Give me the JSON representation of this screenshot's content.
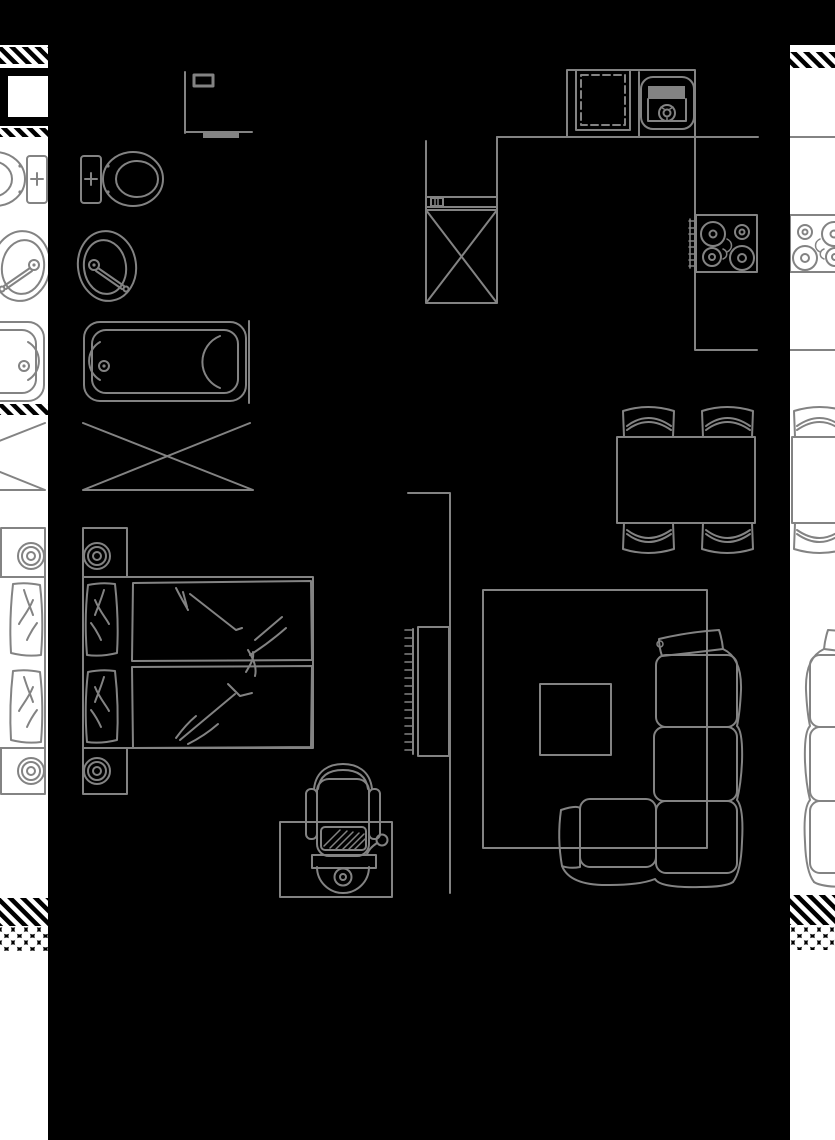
{
  "meta": {
    "description": "architectural-floor-plan",
    "width": 835,
    "height": 1140
  },
  "colors": {
    "background": "#000000",
    "line": "#838383",
    "line_soft": "#8f8f8f",
    "adjacent_background": "#ffffff",
    "wall_graphic": "#000000"
  },
  "floorplan": {
    "unit": {
      "entry": {
        "items": [
          "entry-wall",
          "door-threshold",
          "switch-box"
        ]
      },
      "bathroom": {
        "items": [
          "toilet",
          "washbasin",
          "bathtub",
          "washing-machine"
        ]
      },
      "bedroom": {
        "items": [
          "double-bed",
          "pillow-top",
          "pillow-bottom",
          "duvet-top",
          "duvet-bottom",
          "nightstand-top",
          "table-lamp-top",
          "nightstand-bottom",
          "table-lamp-bottom"
        ]
      },
      "workspace": {
        "items": [
          "desk",
          "office-chair",
          "computer-mouse"
        ]
      },
      "corridor": {
        "items": [
          "partition-wall",
          "radiator"
        ]
      },
      "kitchen": {
        "items": [
          "refrigerator",
          "shelf-unit",
          "counter",
          "dishwasher",
          "kitchen-sink",
          "cooktop-4-burners"
        ]
      },
      "dining": {
        "items": [
          "dining-table",
          "chair-top-left",
          "chair-top-right",
          "chair-bottom-left",
          "chair-bottom-right"
        ]
      },
      "living": {
        "items": [
          "rug",
          "coffee-table",
          "corner-sofa"
        ]
      }
    },
    "adjacent_units": {
      "left_strip": {
        "content": "mirrored-neighbor-unit",
        "wall_bands": [
          "diagonal-hatch",
          "door-opening-box",
          "diagonal-hatch",
          "diagonal-hatch",
          "diagonal-hatch",
          "insulation-pebbles"
        ]
      },
      "right_strip": {
        "content": "mirrored-neighbor-unit",
        "wall_bands": [
          "diagonal-hatch",
          "diagonal-hatch",
          "insulation-pebbles"
        ]
      }
    }
  }
}
